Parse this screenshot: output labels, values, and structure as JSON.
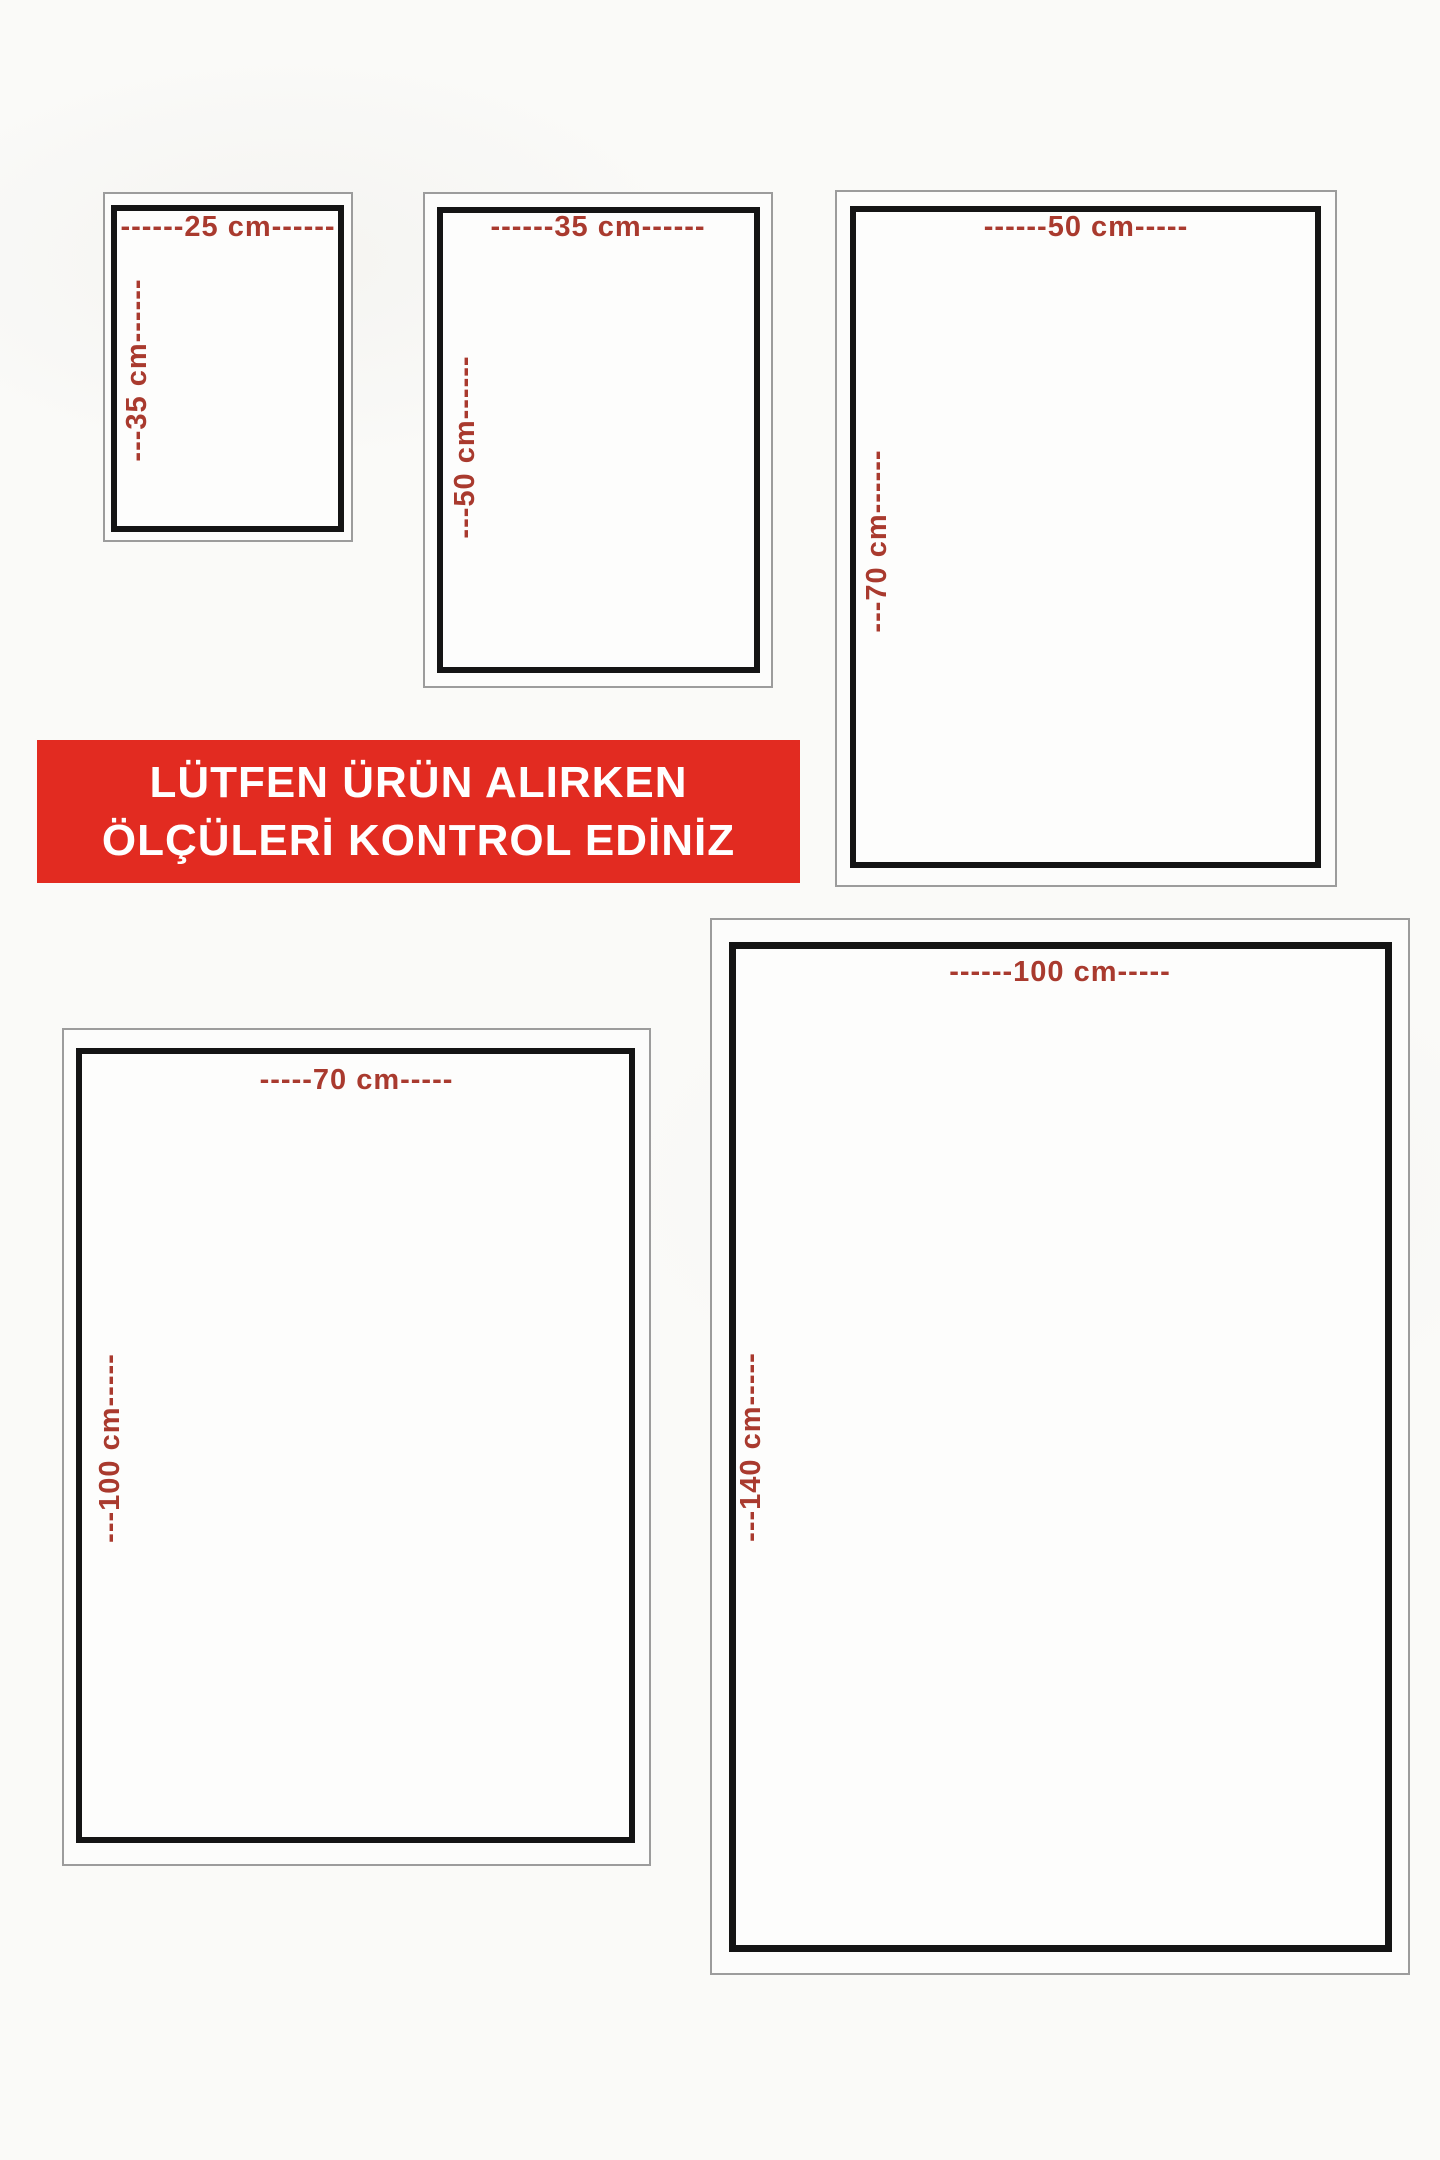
{
  "banner": {
    "line1": "LÜTFEN ÜRÜN ALIRKEN",
    "line2": "ÖLÇÜLERİ KONTROL EDİNİZ",
    "bg_color": "#e22b21",
    "text_color": "#ffffff"
  },
  "sizes": [
    {
      "name": "25x35",
      "width_cm": 25,
      "height_cm": 35,
      "top_label": "------25 cm------",
      "side_label": "---35 cm------"
    },
    {
      "name": "35x50",
      "width_cm": 35,
      "height_cm": 50,
      "top_label": "------35 cm------",
      "side_label": "---50 cm------"
    },
    {
      "name": "50x70",
      "width_cm": 50,
      "height_cm": 70,
      "top_label": "------50 cm-----",
      "side_label": "---70 cm------"
    },
    {
      "name": "70x100",
      "width_cm": 70,
      "height_cm": 100,
      "top_label": "-----70 cm-----",
      "side_label": "---100 cm-----"
    },
    {
      "name": "100x140",
      "width_cm": 100,
      "height_cm": 140,
      "top_label": "------100 cm-----",
      "side_label": "---140 cm-----"
    }
  ],
  "colors": {
    "label_red": "#a93a2e",
    "border_black": "#141414",
    "border_gray": "#9c9c9c",
    "background": "#fafaf8"
  }
}
